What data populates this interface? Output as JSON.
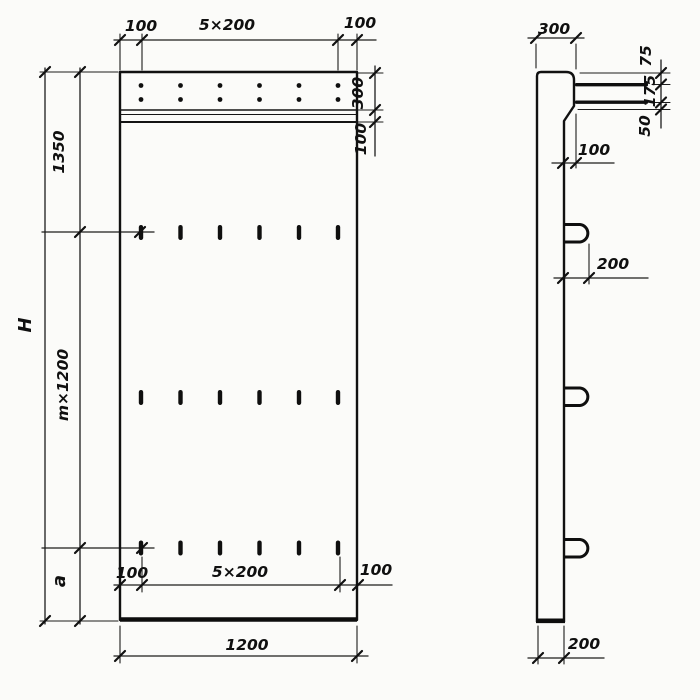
{
  "front_view": {
    "dim_top_left": "100",
    "dim_top_center": "5×200",
    "dim_top_right": "100",
    "dim_strip_height": "300",
    "dim_band_height": "100",
    "dim_upper_left": "1350",
    "dim_overall_height": "H",
    "dim_module_height": "m×1200",
    "dim_bottom_section": "a",
    "dim_bottom_left": "100",
    "dim_bottom_center": "5×200",
    "dim_bottom_right": "100",
    "dim_overall_width": "1200"
  },
  "side_view": {
    "dim_top_width": "300",
    "dim_top_to_rod1": "75",
    "dim_rod1_to_rod2": "175",
    "dim_rod2_to_ledge": "50",
    "dim_ledge_offset": "100",
    "dim_loop_length": "200",
    "dim_thickness": "200"
  }
}
